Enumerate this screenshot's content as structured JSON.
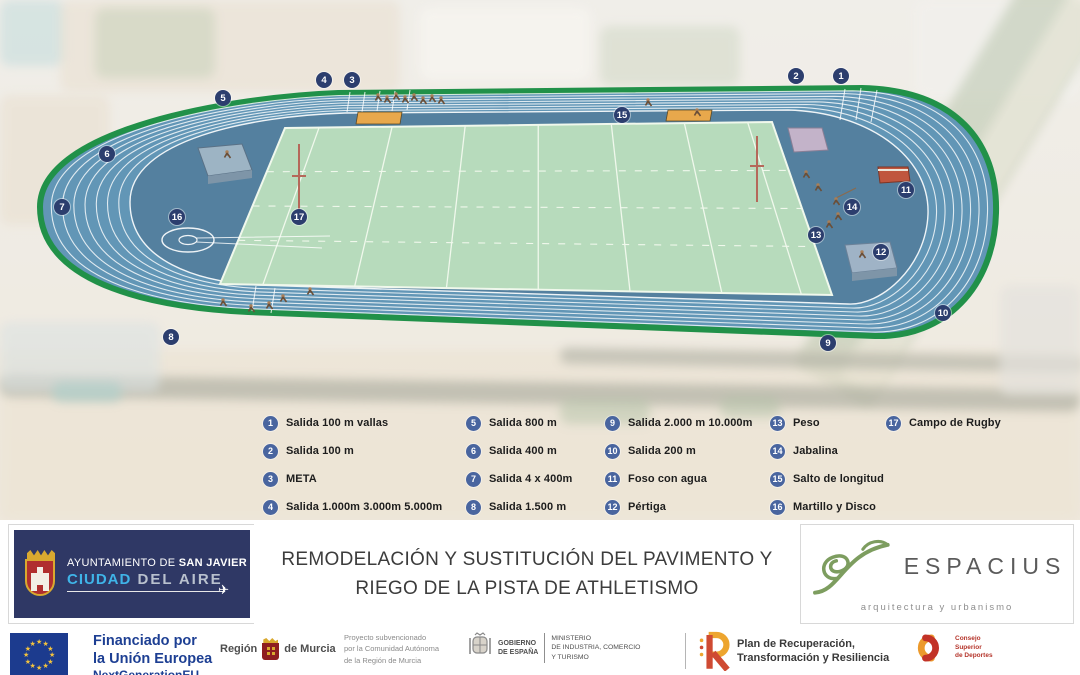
{
  "map": {
    "markers": [
      {
        "n": "1",
        "x": 841,
        "y": 76
      },
      {
        "n": "2",
        "x": 796,
        "y": 76
      },
      {
        "n": "3",
        "x": 352,
        "y": 80
      },
      {
        "n": "4",
        "x": 324,
        "y": 80
      },
      {
        "n": "5",
        "x": 223,
        "y": 98
      },
      {
        "n": "6",
        "x": 107,
        "y": 154
      },
      {
        "n": "7",
        "x": 62,
        "y": 207
      },
      {
        "n": "8",
        "x": 171,
        "y": 337
      },
      {
        "n": "9",
        "x": 828,
        "y": 343
      },
      {
        "n": "10",
        "x": 943,
        "y": 313
      },
      {
        "n": "11",
        "x": 906,
        "y": 190
      },
      {
        "n": "12",
        "x": 881,
        "y": 252
      },
      {
        "n": "13",
        "x": 816,
        "y": 235
      },
      {
        "n": "14",
        "x": 852,
        "y": 207
      },
      {
        "n": "15",
        "x": 622,
        "y": 115
      },
      {
        "n": "16",
        "x": 177,
        "y": 217
      },
      {
        "n": "17",
        "x": 299,
        "y": 217
      }
    ]
  },
  "legend": {
    "columns": [
      {
        "items": [
          {
            "n": "1",
            "label": "Salida 100 m vallas"
          },
          {
            "n": "2",
            "label": "Salida 100 m"
          },
          {
            "n": "3",
            "label": "META"
          },
          {
            "n": "4",
            "label": "Salida 1.000m 3.000m 5.000m"
          }
        ]
      },
      {
        "items": [
          {
            "n": "5",
            "label": "Salida 800 m"
          },
          {
            "n": "6",
            "label": "Salida 400 m"
          },
          {
            "n": "7",
            "label": "Salida 4 x 400m"
          },
          {
            "n": "8",
            "label": "Salida 1.500 m"
          }
        ]
      },
      {
        "items": [
          {
            "n": "9",
            "label": "Salida 2.000 m 10.000m"
          },
          {
            "n": "10",
            "label": "Salida 200 m"
          },
          {
            "n": "11",
            "label": "Foso con agua"
          },
          {
            "n": "12",
            "label": "Pértiga"
          }
        ]
      },
      {
        "items": [
          {
            "n": "13",
            "label": "Peso"
          },
          {
            "n": "14",
            "label": "Jabalina"
          },
          {
            "n": "15",
            "label": "Salto de longitud"
          },
          {
            "n": "16",
            "label": "Martillo y Disco"
          }
        ]
      },
      {
        "items": [
          {
            "n": "17",
            "label": "Campo de Rugby"
          }
        ]
      }
    ]
  },
  "banner": {
    "municipality": {
      "line1_prefix": "AYUNTAMIENTO DE ",
      "line1_bold": "SAN JAVIER",
      "line2_accent": "CIUDAD",
      "line2_rest": " DEL AIRE"
    },
    "title_line1": "REMODELACIÓN Y SUSTITUCIÓN DEL PAVIMENTO Y",
    "title_line2": "RIEGO DE LA PISTA DE ATHLETISMO",
    "studio": {
      "name": "ESPACIUS",
      "tagline": "arquitectura y urbanismo"
    }
  },
  "footer": {
    "eu": {
      "line1": "Financiado por",
      "line2": "la Unión Europea",
      "line3": "NextGenerationEU"
    },
    "murcia": {
      "left": "Región",
      "right": "de Murcia"
    },
    "subsidy": {
      "l1": "Proyecto subvencionado",
      "l2": "por la Comunidad Autónoma",
      "l3": "de la Región de Murcia"
    },
    "gobierno": {
      "l1": "GOBIERNO",
      "l2": "DE ESPAÑA"
    },
    "ministerio": {
      "l1": "MINISTERIO",
      "l2": "DE INDUSTRIA, COMERCIO",
      "l3": "Y TURISMO"
    },
    "prtr": {
      "l1": "Plan de Recuperación,",
      "l2": "Transformación y Resiliencia"
    },
    "csd": {
      "l1": "Consejo",
      "l2": "Superior",
      "l3": "de Deportes"
    }
  },
  "colors": {
    "track_blue": "#6296b6",
    "infield_blue": "#54809f",
    "border_green": "#219149",
    "rugby_green": "#b7dbbc",
    "marker_navy": "#2c3e6e",
    "legend_badge": "#49659f",
    "eu_blue": "#1d3f93",
    "espacius_green": "#7d9d5f",
    "prtr_red": "#cf4a32",
    "prtr_yellow": "#eda52f"
  }
}
